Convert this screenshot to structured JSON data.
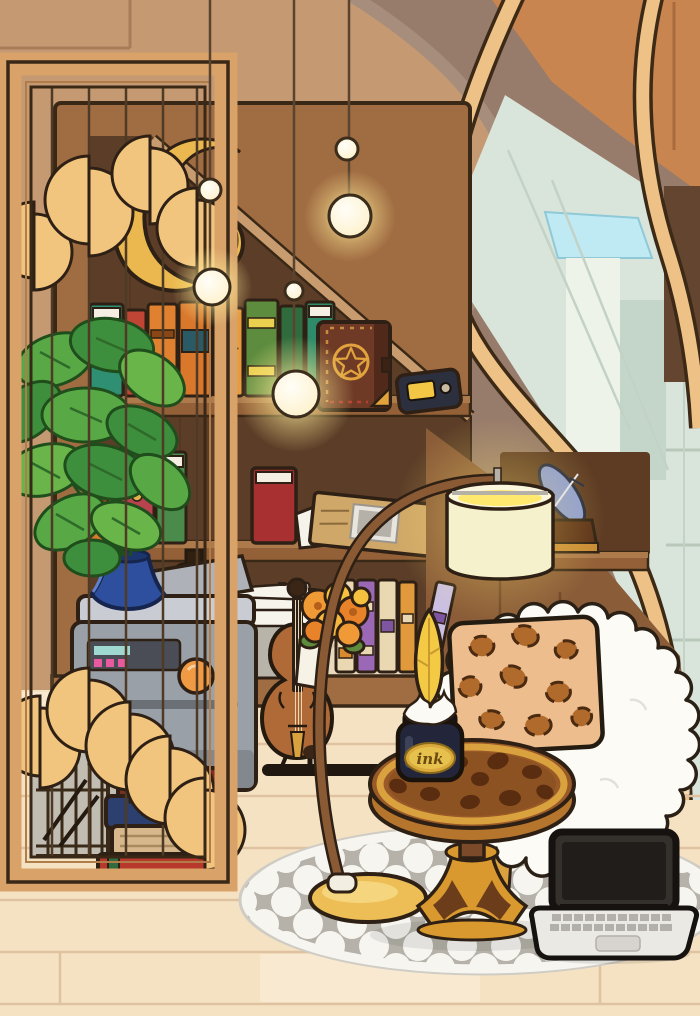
{
  "labels": {
    "ink_jar_label": "ink"
  },
  "palette": {
    "wall_light": "#c59a72",
    "wall_base": "#b58965",
    "stair_shadow": "#977b6b",
    "stringer_wood": "#eec186",
    "orange_panel": "#c9854f",
    "window_glass": "#d9e5da",
    "awning_cyan": "#bfeaf4",
    "divider_wood": "#d8a269",
    "bookshelf_wood": "#a06c42",
    "alcove_dark": "#5c3e28",
    "accent_gold": "#eab84e",
    "plant_green": "#58a845",
    "vase_blue": "#2e4f9e",
    "printer_gray": "#9aa0a8",
    "leopard_tan": "#edbd8d",
    "leopard_spot": "#b06a2b",
    "table_brown": "#9a5a28",
    "ink_navy": "#23263a",
    "quill_yellow": "#f4ca45",
    "chair_white": "#fcfbf6",
    "rug_gray": "#b6b2a9",
    "floor": "#f5e2c3",
    "glow": "#ffe96e",
    "outline": "#2e2014"
  },
  "objects": [
    "room-divider-screen",
    "circle-garland",
    "hanging-orb-lights",
    "bookshelf",
    "gold-moon-sculpture",
    "spell-book",
    "mini-radio",
    "monstera-plant",
    "blue-vase",
    "printer",
    "dark-bottle",
    "paper-stack",
    "flower-bouquet",
    "violin",
    "striped-books",
    "newspaper-clipboard",
    "red-book",
    "book-stack",
    "birdcage",
    "arc-floor-lamp",
    "quill-trophy",
    "fluffy-armchair",
    "leopard-pillow",
    "leopard-side-table",
    "ink-jar",
    "feather-quill",
    "laptop",
    "trellis-rug",
    "staircase",
    "window"
  ]
}
